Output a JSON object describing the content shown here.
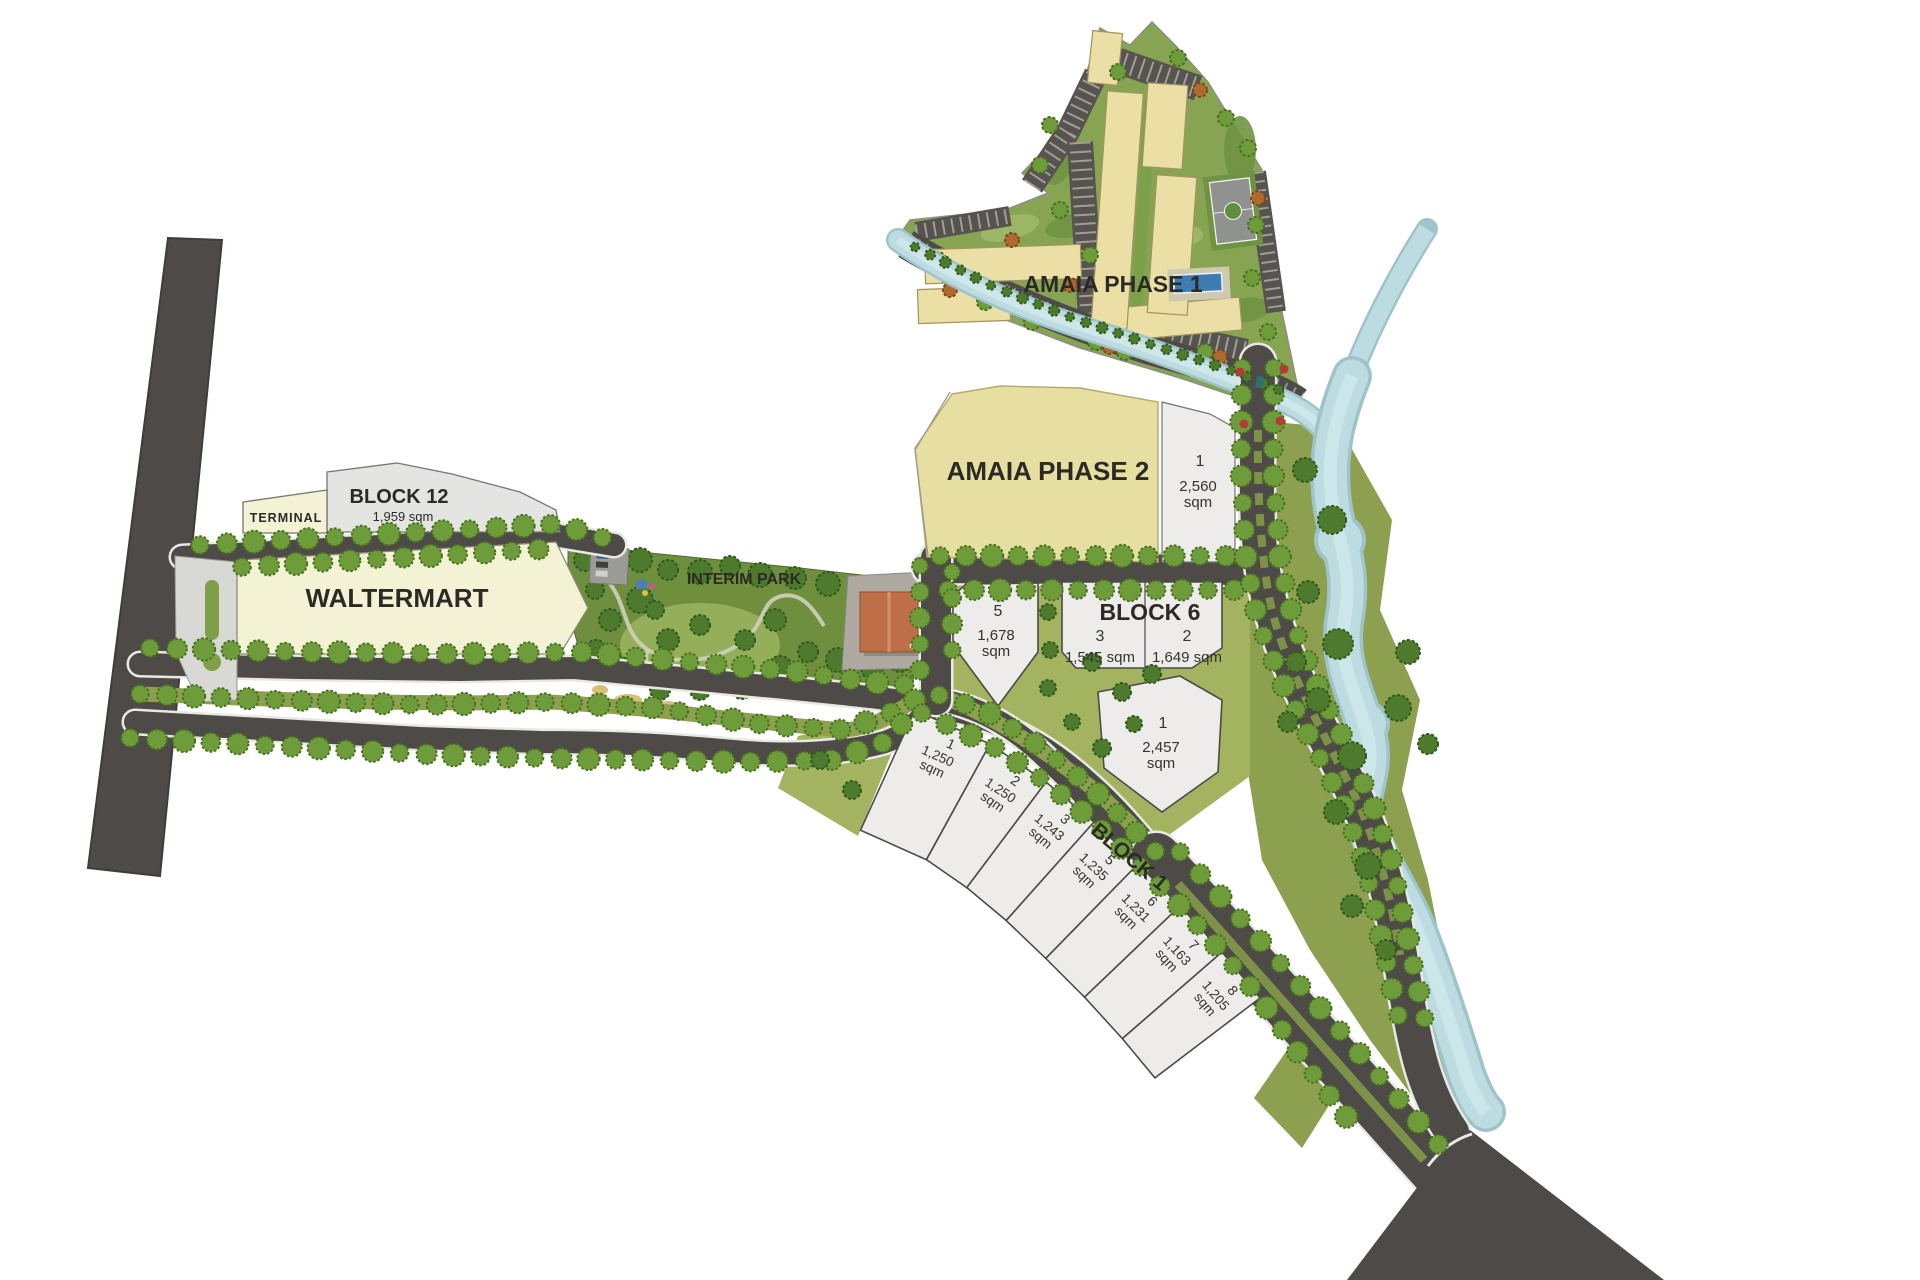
{
  "page": {
    "type": "site-development-plan",
    "background": "#ffffff"
  },
  "labels": {
    "amaia_phase_1": "AMAIA PHASE 1",
    "amaia_phase_2": "AMAIA PHASE 2",
    "block_12": "BLOCK 12",
    "block_12_area": "1,959 sqm",
    "terminal": "TERMINAL",
    "waltermart": "WALTERMART",
    "interim_park": "INTERIM PARK",
    "block_6": "BLOCK 6",
    "block_1": "BLOCK 1"
  },
  "lots": {
    "phase2_frontage": {
      "no": "1",
      "area": "2,560",
      "unit": "sqm"
    },
    "block_6": [
      {
        "no": "5",
        "area": "1,678",
        "unit": "sqm"
      },
      {
        "no": "3",
        "area_label": "1,545 sqm"
      },
      {
        "no": "2",
        "area_label": "1,649 sqm"
      },
      {
        "no": "1",
        "area": "2,457",
        "unit": "sqm"
      }
    ],
    "block_1": [
      {
        "no": "1",
        "area": "1,250",
        "unit": "sqm"
      },
      {
        "no": "2",
        "area": "1,250",
        "unit": "sqm"
      },
      {
        "no": "3",
        "area": "1,243",
        "unit": "sqm"
      },
      {
        "no": "5",
        "area": "1,235",
        "unit": "sqm"
      },
      {
        "no": "6",
        "area": "1,231",
        "unit": "sqm"
      },
      {
        "no": "7",
        "area": "1,163",
        "unit": "sqm"
      },
      {
        "no": "8",
        "area": "1,205",
        "unit": "sqm"
      }
    ]
  },
  "colors": {
    "road": "#4d4a47",
    "road_parking": "#57534f",
    "curb": "#e9e9e4",
    "river": "#bcdce1",
    "river_edge": "#9fc3c9",
    "river_core": "#d8ecee",
    "tree": "#6f9c3a",
    "tree_edge": "#47701f",
    "tree_dark": "#4e7a2e",
    "tree_dark_edge": "#2f5a1d",
    "tree_orange": "#b0692f",
    "tree_orange_edge": "#7d4517",
    "ground_olive": "#8da050",
    "ground_light": "#a3b35f",
    "park_base": "#6f8f3e",
    "park_meadow": "#94ae59",
    "phase1_green": "#87a453",
    "parcel_cream": "#f3f2d5",
    "parcel_yellow": "#e7dfa2",
    "parcel_gray": "#e4e4e2",
    "lot_fill": "#edecea",
    "lot_edge": "#4b4b48",
    "building": "#ebdfa6",
    "building_edge": "#a3935e",
    "roof_orange": "#bf6f48",
    "pool": "#3e7cb1",
    "court": "#8f928f",
    "flower_red": "#b33b33",
    "text": "#2b2a26"
  }
}
